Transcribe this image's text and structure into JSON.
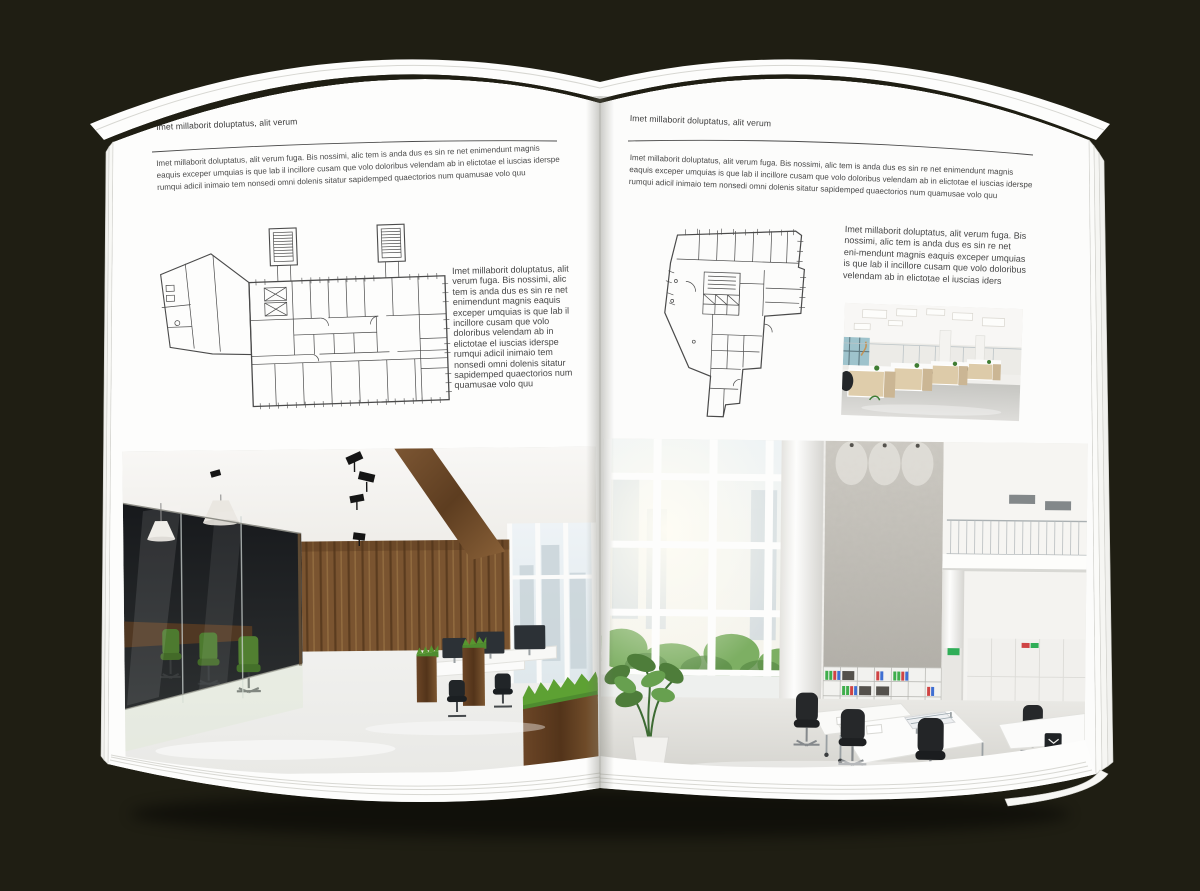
{
  "scene": {
    "background_color": "#1f1e13",
    "paper_color": "#fdfdfc",
    "palette": {
      "wood_brown": "#7a5430",
      "chair_green": "#4d7a2f",
      "binder_green": "#3fae4c",
      "binder_red": "#cf4444",
      "binder_blue": "#3f6fd2",
      "window_sky": "#e6edf1"
    }
  },
  "left_page": {
    "header": "Imet millaborit doluptatus, alit verum",
    "intro": "Imet millaborit doluptatus, alit verum fuga. Bis nossimi, alic tem is anda dus es sin re net enimendunt magnis eaquis exceper umquias is que lab il incillore cusam que volo doloribus velendam ab in elictotae el iuscias iderspe rumqui adicil inimaio tem nonsedi omni dolenis sitatur sapidemped quaectorios num quamusae volo quu",
    "side_text": "Imet millaborit doluptatus, alit verum fuga. Bis nossimi, alic tem is anda dus es sin re net enimendunt magnis eaquis exceper umquias is que lab il incillore cusam que volo doloribus velendam ab in elictotae el iuscias iderspe rumqui adicil inimaio tem nonsedi omni dolenis sitatur sapidemped quaectorios num quamusae volo quu",
    "floor_plan": "architectural-floor-plan-rectangular-block",
    "photo": "office-interior-wood-and-glass"
  },
  "right_page": {
    "header": "Imet millaborit doluptatus, alit verum",
    "intro": "Imet millaborit doluptatus, alit verum fuga. Bis nossimi, alic tem is anda dus es sin re net enimendunt magnis eaquis exceper umquias is que lab il incillore cusam que volo doloribus velendam ab in elictotae el iuscias iderspe rumqui adicil inimaio tem nonsedi omni dolenis sitatur sapidemped quaectorios num quamusae volo quu",
    "side_text": "Imet millaborit doluptatus, alit verum fuga. Bis nossimi, alic tem is anda dus es sin re net eni-mendunt magnis eaquis exceper umquias is que lab il incillore cusam que volo doloribus velendam ab in elictotae el iuscias iders",
    "floor_plan": "architectural-floor-plan-irregular-block",
    "photo_small": "office-interior-workstations",
    "photo_large": "office-interior-white-atrium"
  }
}
